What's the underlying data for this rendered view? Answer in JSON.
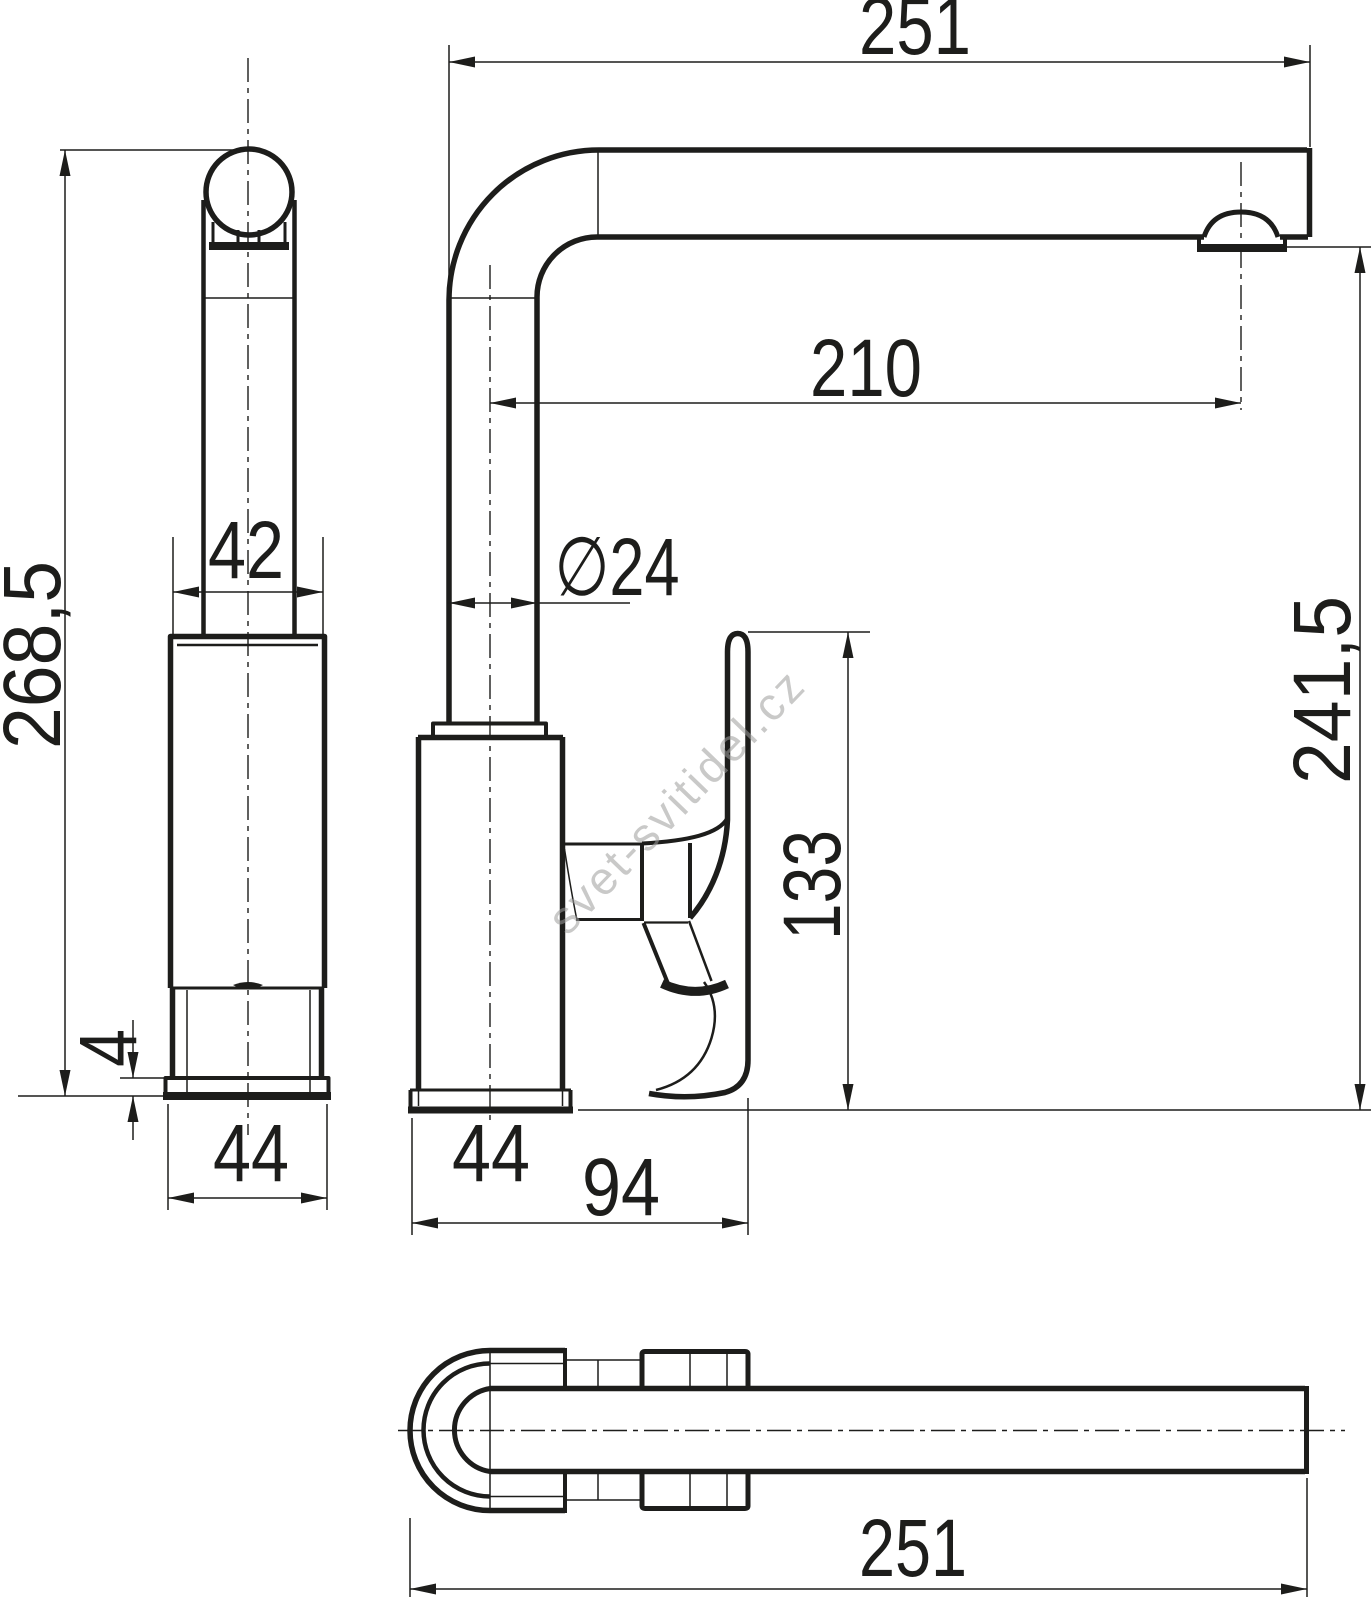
{
  "drawing": {
    "type": "technical-dimension-drawing",
    "subject": "kitchen faucet (three orthographic views)",
    "background": "#ffffff",
    "line_color": "#1d1d1b",
    "dimensions": {
      "spout_reach_top": "251",
      "spout_horizontal_projection": "210",
      "spout_tube_diameter": "∅24",
      "total_height": "268,5",
      "spout_outlet_height": "241,5",
      "handle_top_height": "133",
      "body_width": "42",
      "base_plate_thickness": "4",
      "base_width_side_view": "44",
      "base_width_front_view": "44",
      "body_depth_with_handle": "94",
      "spout_reach_bottom": "251"
    }
  },
  "watermark": {
    "text": "svet-svitidel.cz",
    "color": "#9d9d9c"
  }
}
